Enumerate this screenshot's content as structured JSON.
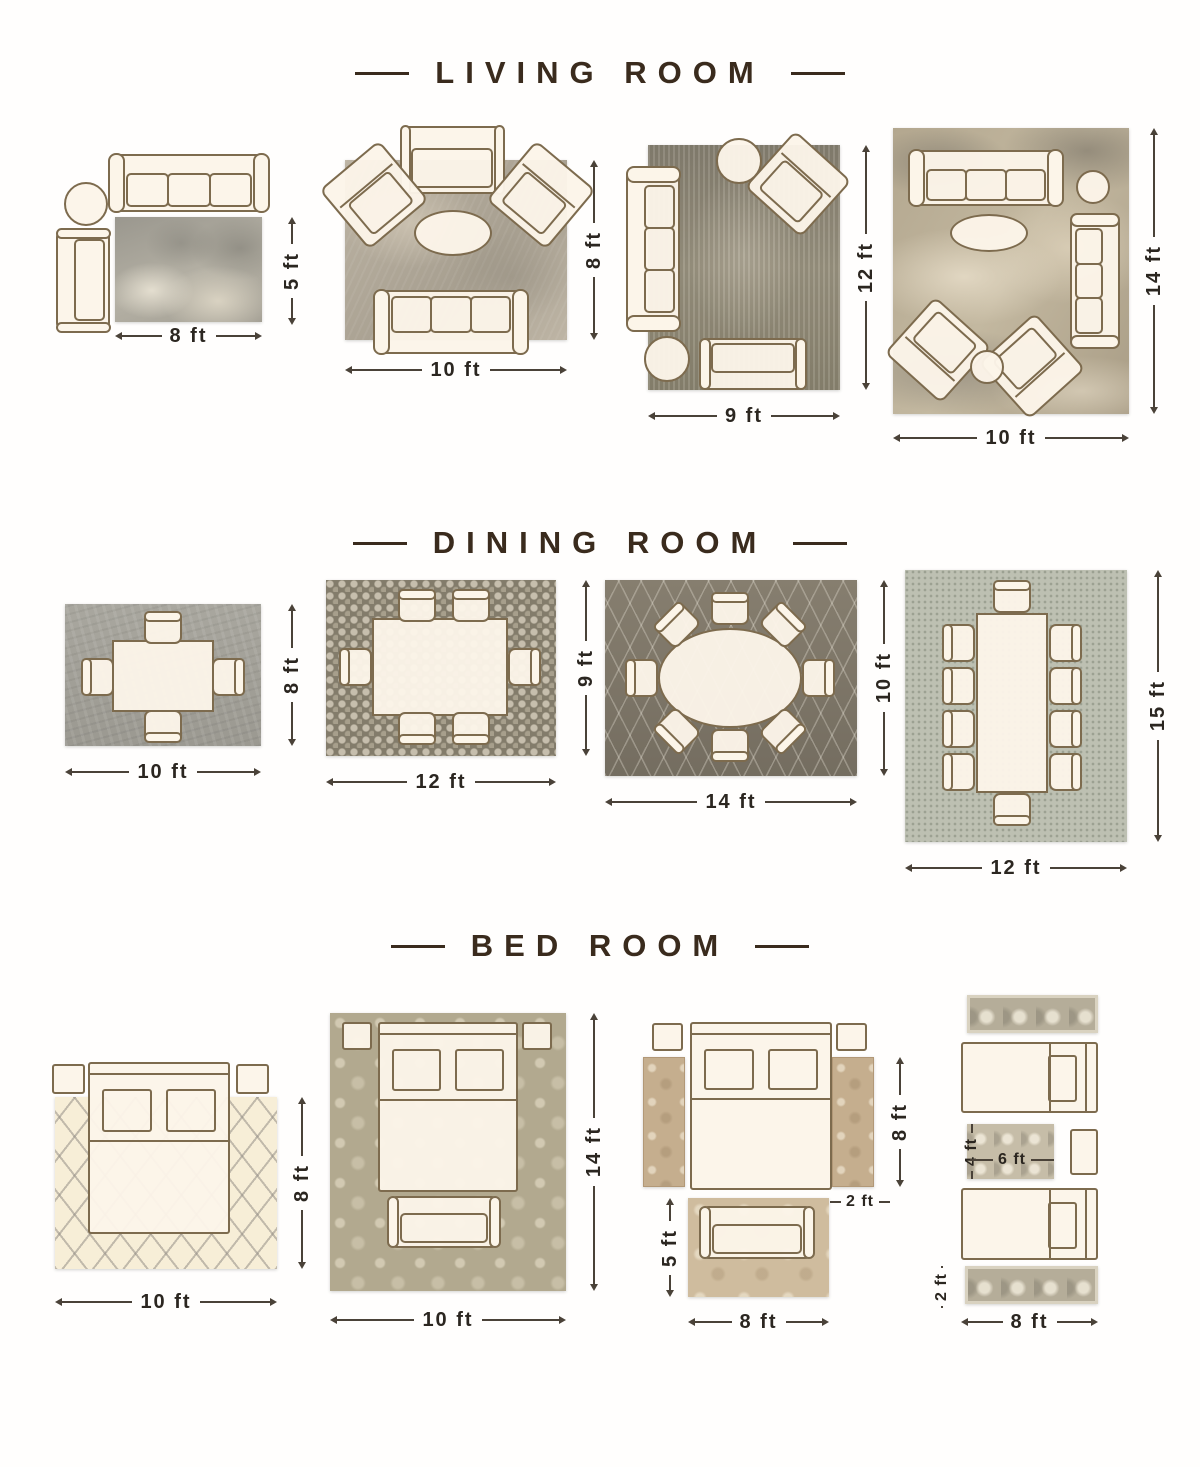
{
  "colors": {
    "title_text": "#3a2b1d",
    "dimension_text": "#2b2620",
    "furniture_fill": "#fcf5e9",
    "furniture_border": "#7d6b4e"
  },
  "sections": [
    {
      "title": "LIVING ROOM",
      "layouts": [
        {
          "width_label": "8 ft",
          "height_label": "5 ft"
        },
        {
          "width_label": "10 ft",
          "height_label": "8 ft"
        },
        {
          "width_label": "9 ft",
          "height_label": "12 ft"
        },
        {
          "width_label": "10 ft",
          "height_label": "14 ft"
        }
      ]
    },
    {
      "title": "DINING ROOM",
      "layouts": [
        {
          "width_label": "10 ft",
          "height_label": "8 ft"
        },
        {
          "width_label": "12 ft",
          "height_label": "9 ft"
        },
        {
          "width_label": "14 ft",
          "height_label": "10 ft"
        },
        {
          "width_label": "12 ft",
          "height_label": "15 ft"
        }
      ]
    },
    {
      "title": "BED ROOM",
      "layouts": [
        {
          "width_label": "10 ft",
          "height_label": "8 ft"
        },
        {
          "width_label": "10 ft",
          "height_label": "14 ft"
        },
        {
          "width_label": "8 ft",
          "side_runner_height_label": "8 ft",
          "side_runner_width_label": "2 ft",
          "foot_rug_height_label": "5 ft"
        },
        {
          "width_label": "8 ft",
          "runner_height_label": "2 ft",
          "center_rug_width_label": "6 ft",
          "center_rug_height_label": "4 ft"
        }
      ]
    }
  ]
}
